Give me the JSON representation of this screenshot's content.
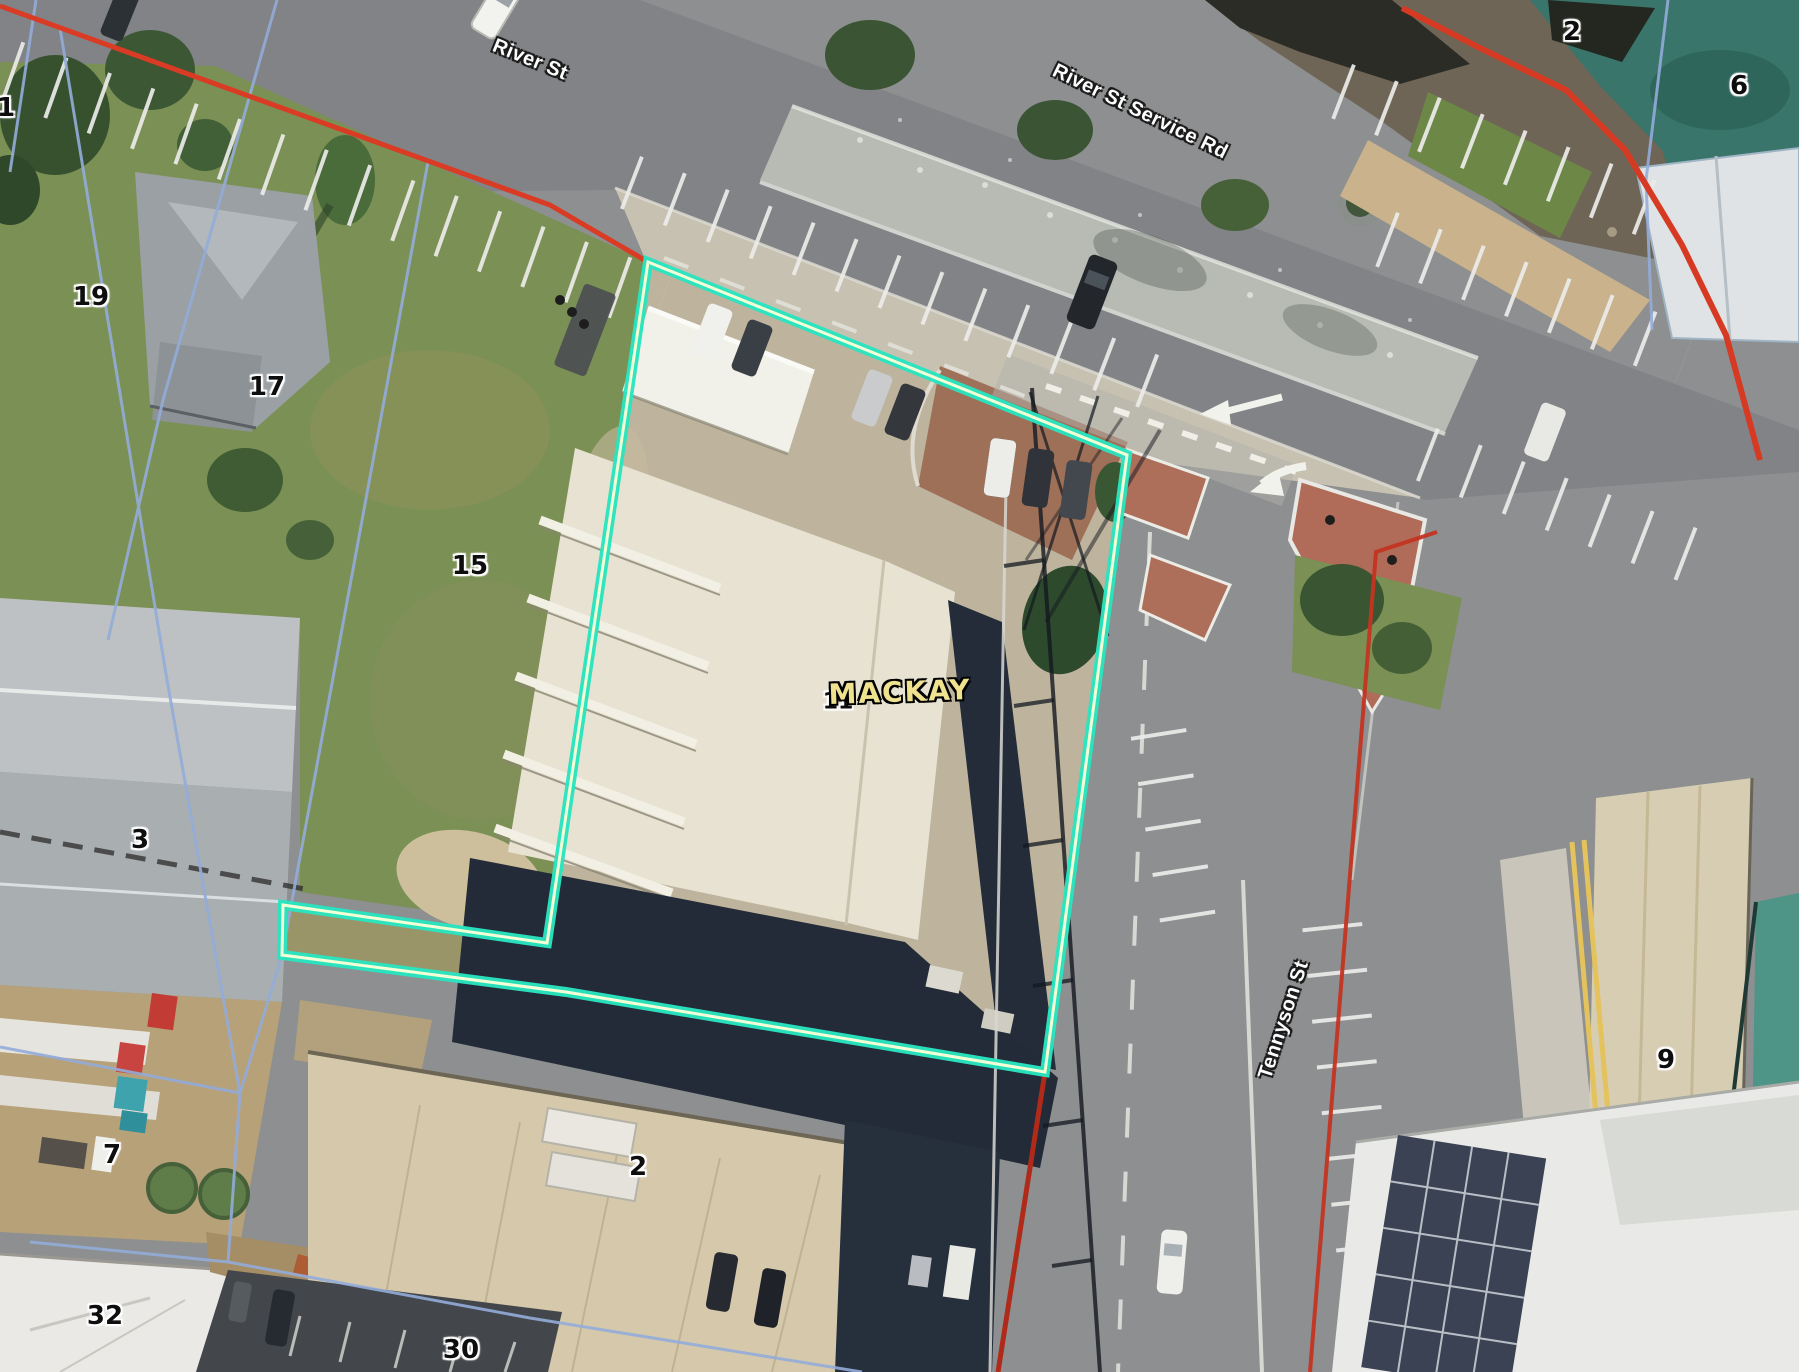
{
  "map": {
    "street_labels": [
      {
        "text": "River St",
        "x": 530,
        "y": 60,
        "rotation": 22
      },
      {
        "text": "River St Service Rd",
        "x": 1140,
        "y": 112,
        "rotation": 26
      },
      {
        "text": "Tennyson St",
        "x": 1284,
        "y": 1020,
        "rotation": -72
      }
    ],
    "lot_numbers": [
      {
        "text": "1",
        "x": 6,
        "y": 108
      },
      {
        "text": "19",
        "x": 91,
        "y": 297
      },
      {
        "text": "17",
        "x": 267,
        "y": 387
      },
      {
        "text": "15",
        "x": 470,
        "y": 566
      },
      {
        "text": "3",
        "x": 140,
        "y": 840
      },
      {
        "text": "7",
        "x": 112,
        "y": 1155
      },
      {
        "text": "32",
        "x": 105,
        "y": 1316
      },
      {
        "text": "30",
        "x": 461,
        "y": 1350
      },
      {
        "text": "2",
        "x": 638,
        "y": 1167
      },
      {
        "text": "11",
        "x": 838,
        "y": 702
      },
      {
        "text": "2",
        "x": 1572,
        "y": 32
      },
      {
        "text": "6",
        "x": 1739,
        "y": 86
      },
      {
        "text": "9",
        "x": 1666,
        "y": 1060
      }
    ],
    "building_labels": [
      {
        "text": "MACKAY",
        "x": 900,
        "y": 692,
        "rotation": -2
      }
    ],
    "overlay_colors": {
      "parcel_highlight": "#29e4bf",
      "parcel_highlight_inner": "#f3ffd4",
      "boundary_red": "#d93a25",
      "boundary_blue": "#93acd9"
    }
  }
}
